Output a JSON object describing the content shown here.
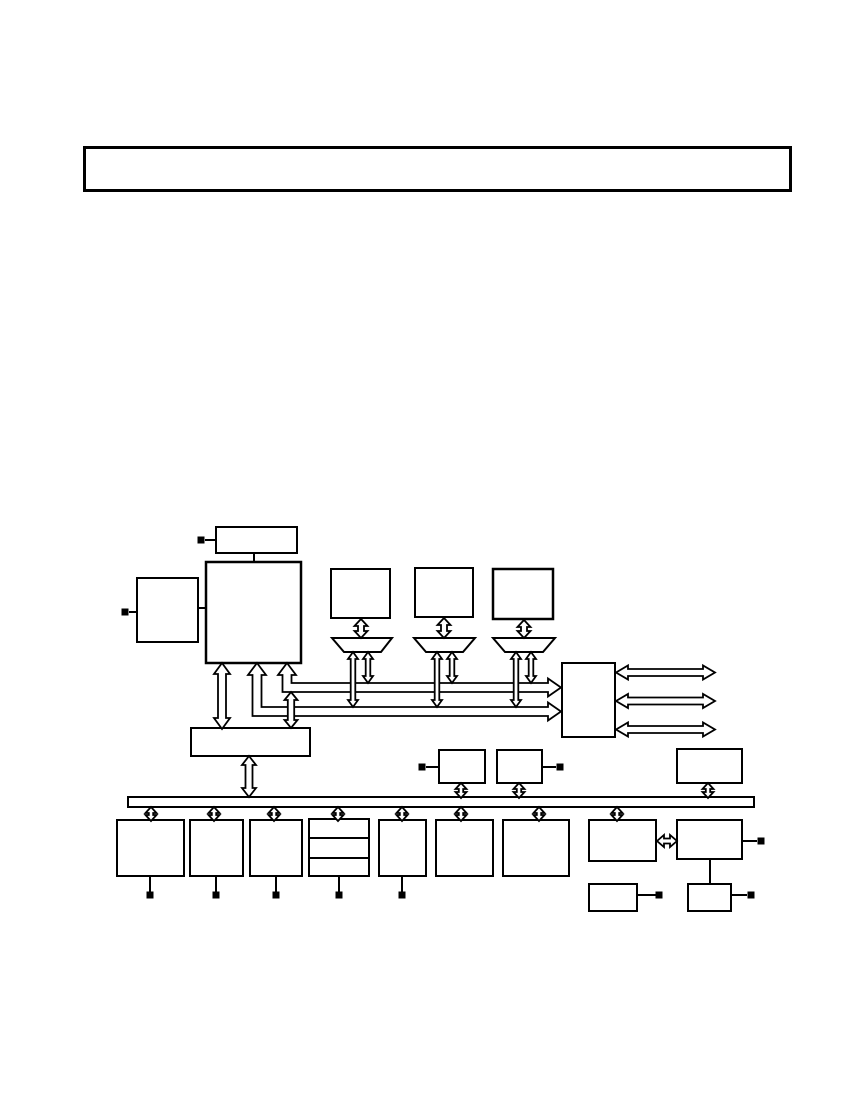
{
  "page": {
    "background_color": "#ffffff",
    "ink_color": "#000000"
  },
  "callout_box": {
    "label": ""
  },
  "diagram": {
    "type": "block-diagram",
    "text_labels": [],
    "blocks": [
      {
        "name": "top-connector-box",
        "label": ""
      },
      {
        "name": "cpu-main-box",
        "label": ""
      },
      {
        "name": "left-io-box",
        "label": ""
      },
      {
        "name": "upper-box-1",
        "label": ""
      },
      {
        "name": "upper-box-2",
        "label": ""
      },
      {
        "name": "upper-box-3",
        "label": ""
      },
      {
        "name": "mux-1",
        "label": ""
      },
      {
        "name": "mux-2",
        "label": ""
      },
      {
        "name": "mux-3",
        "label": ""
      },
      {
        "name": "right-interface-box",
        "label": ""
      },
      {
        "name": "wide-middle-box",
        "label": ""
      },
      {
        "name": "above-bus-box-left",
        "label": ""
      },
      {
        "name": "above-bus-box-right",
        "label": ""
      },
      {
        "name": "above-bus-box-far-right",
        "label": ""
      },
      {
        "name": "system-bus-bar",
        "label": ""
      },
      {
        "name": "bottom-box-1",
        "label": ""
      },
      {
        "name": "bottom-box-2",
        "label": ""
      },
      {
        "name": "bottom-box-3",
        "label": ""
      },
      {
        "name": "bottom-box-4",
        "label": ""
      },
      {
        "name": "bottom-box-5",
        "label": ""
      },
      {
        "name": "bottom-box-6",
        "label": ""
      },
      {
        "name": "bottom-box-7",
        "label": ""
      },
      {
        "name": "bottom-box-8",
        "label": ""
      },
      {
        "name": "bottom-box-9",
        "label": ""
      },
      {
        "name": "bottom-box-10",
        "label": ""
      },
      {
        "name": "bottom-box-11",
        "label": ""
      }
    ],
    "bus_arrow_style": "hollow-outline",
    "horizontal_io_arrow_count": 3,
    "terminal_square_count": 12
  }
}
